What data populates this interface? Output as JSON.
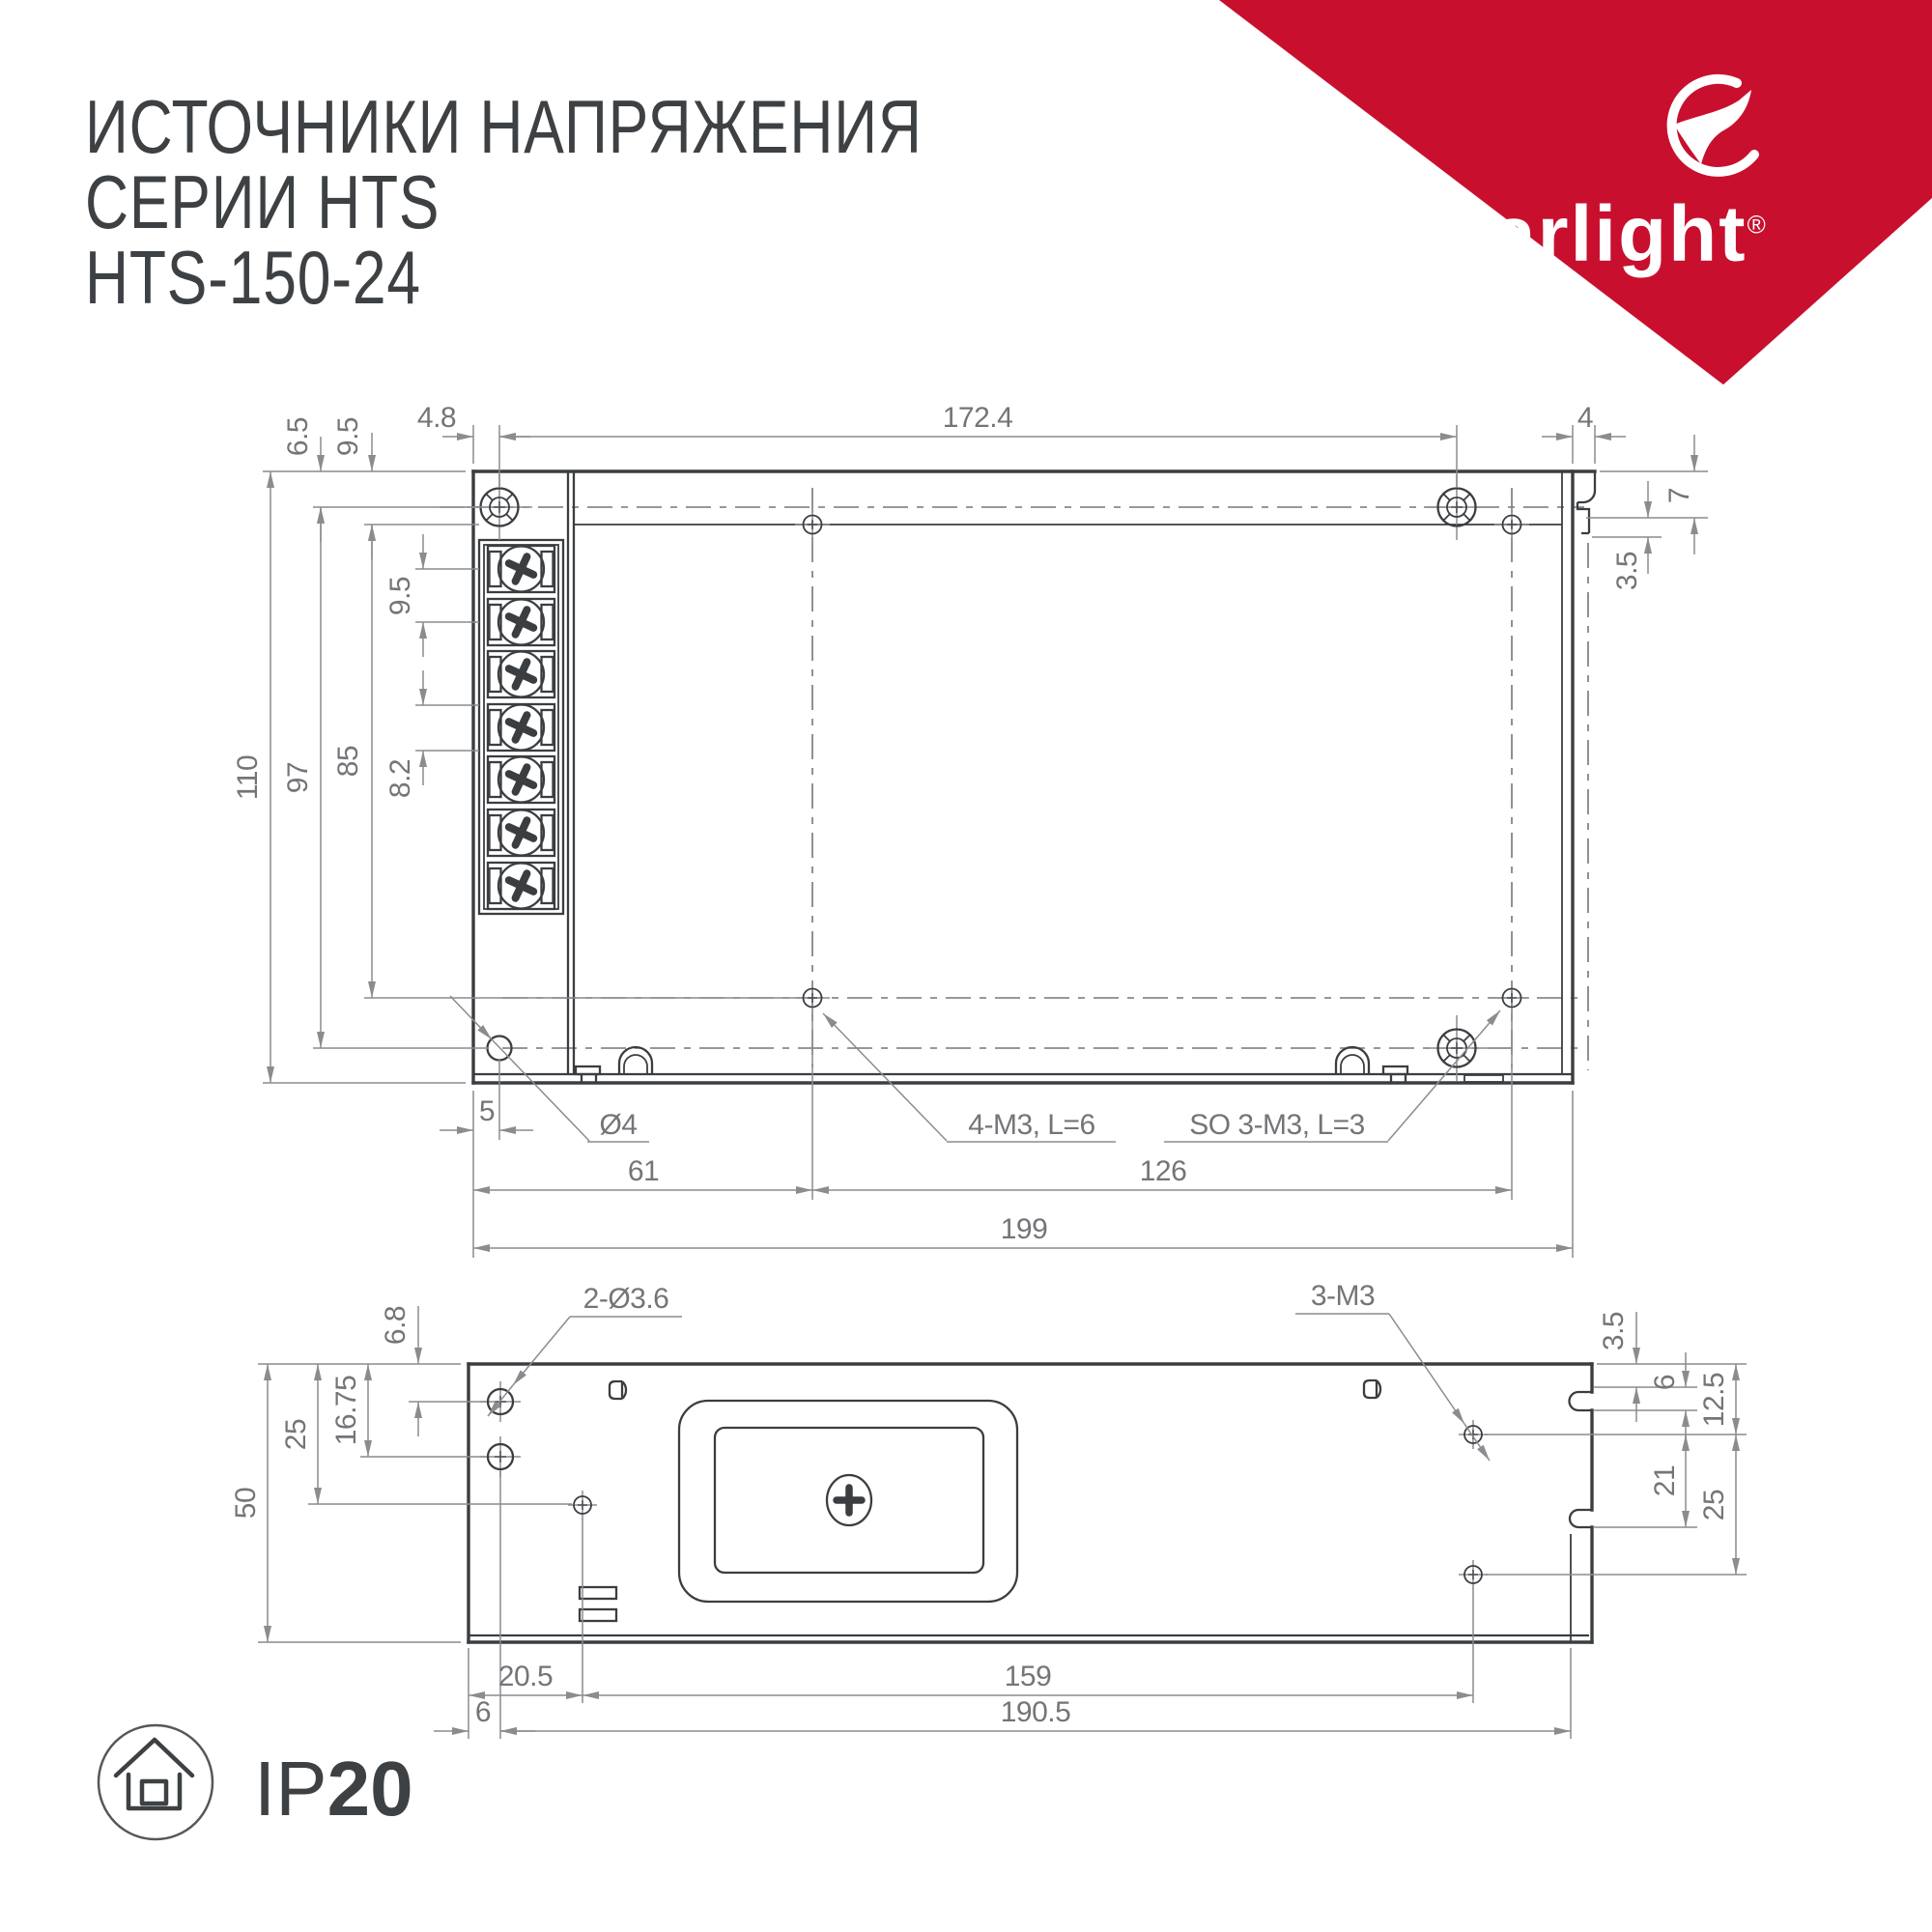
{
  "header": {
    "line1": "ИСТОЧНИКИ НАПРЯЖЕНИЯ",
    "line2": "СЕРИИ HTS",
    "line3": "HTS-150-24"
  },
  "brand": {
    "name": "arlight",
    "reg": "®",
    "accent_color": "#c8102e"
  },
  "ip_badge": {
    "prefix": "IP",
    "value": "20"
  },
  "top_view": {
    "top": {
      "offset_x": "4.8",
      "span": "172.4",
      "lip": "4"
    },
    "left": {
      "h_total": "110",
      "h_screws": "97",
      "h_holes": "85",
      "off_top": "6.5",
      "off_step": "9.5",
      "pitch": "9.5",
      "cell": "8.2"
    },
    "right": {
      "lip_h": "7",
      "notch": "3.5"
    },
    "bottom": {
      "off_hole": "5",
      "hole_d": "Ø4",
      "m3_label": "4-M3, L=6",
      "so_label": "SO 3-M3, L=3",
      "d61": "61",
      "d126": "126",
      "total": "199"
    }
  },
  "side_view": {
    "top": {
      "holes2": "2-Ø3.6",
      "m3": "3-M3"
    },
    "left": {
      "off1": "6.8",
      "off2": "25",
      "off3": "16.75",
      "h_total": "50"
    },
    "right": {
      "r1": "3.5",
      "r2": "6",
      "r3": "12.5",
      "r4": "21",
      "r5": "25"
    },
    "bottom": {
      "b1": "20.5",
      "b2": "159",
      "b3": "6",
      "total": "190.5"
    }
  }
}
